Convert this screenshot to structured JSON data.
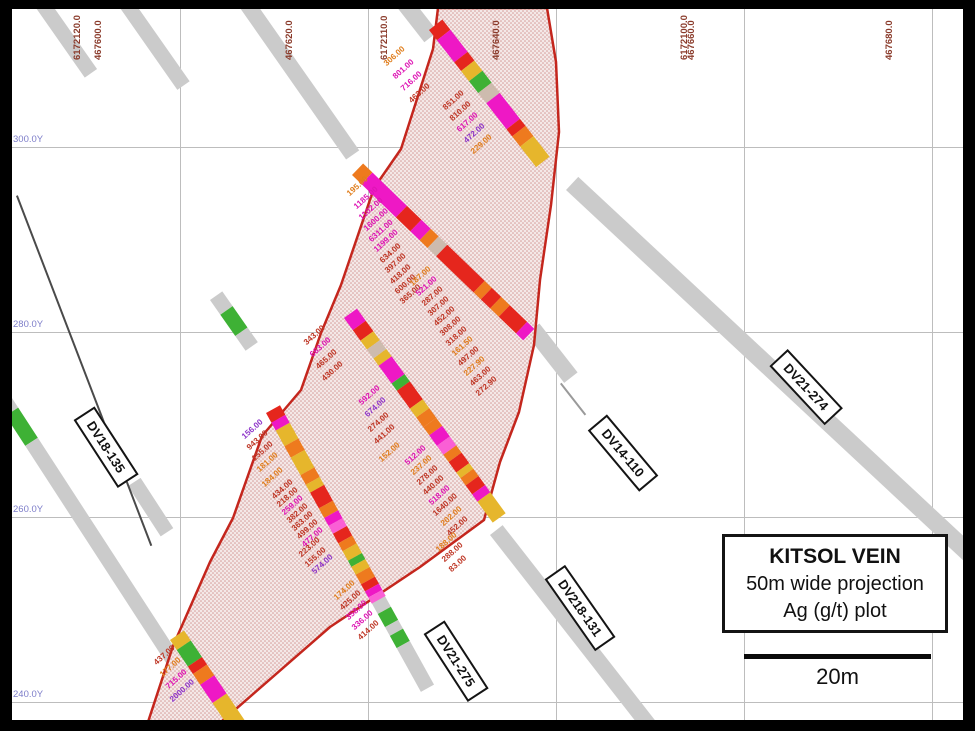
{
  "legend": {
    "title": "KITSOL VEIN",
    "line2": "50m wide projection",
    "line3": "Ag (g/t) plot"
  },
  "scale_bar": {
    "label": "20m"
  },
  "axes": {
    "grid_x": [
      180,
      368,
      556,
      744,
      932
    ],
    "grid_y": [
      147,
      332,
      517,
      702
    ],
    "top_labels": [
      {
        "text": "6172120.0",
        "x": 72
      },
      {
        "text": "467600.0",
        "x": 93
      },
      {
        "text": "467620.0",
        "x": 284
      },
      {
        "text": "6172110.0",
        "x": 379
      },
      {
        "text": "467640.0",
        "x": 491
      },
      {
        "text": "6172100.0",
        "x": 679
      },
      {
        "text": "467660.0",
        "x": 686
      },
      {
        "text": "467680.0",
        "x": 884
      }
    ],
    "left_labels": [
      {
        "text": "300.0Y",
        "y": 147
      },
      {
        "text": "280.0Y",
        "y": 332
      },
      {
        "text": "260.0Y",
        "y": 517
      },
      {
        "text": "240.0Y",
        "y": 702
      }
    ]
  },
  "colors": {
    "gray": "#cbcbcb",
    "linegray": "#9a9a9a",
    "dark": "#4a4a4a",
    "green": "#3eb135",
    "red": "#e5261d",
    "magenta": "#ee18c5",
    "orange": "#ee7a1e",
    "gold": "#e6b62c",
    "tan": "#cdbbae",
    "pink": "#fa5fd5",
    "vo": "#e07e1d",
    "vr": "#bf3726",
    "vm": "#de14b4",
    "vv": "#8e35c9",
    "outline": "#c4261d",
    "grid": "#bdbdbd",
    "coord": "#8a3a2a",
    "ycoord": "#7d7dc9"
  },
  "polygon": {
    "path": "M438,8 L547,8 L556,62 L559,132 L551,205 L540,280 L534,345 L519,412 L500,462 L484,520 L420,567 L330,627 L221,722 L148,722 L173,646 L210,562 L233,518 L262,436 L301,390 L321,333 L341,285 L374,188 L401,149 L433,49 Z"
  },
  "drill_labels": [
    {
      "text": "DV18-135",
      "x": 106,
      "y": 447,
      "rot": 57
    },
    {
      "text": "DV14-110",
      "x": 623,
      "y": 453,
      "rot": 50
    },
    {
      "text": "DV21-274",
      "x": 806,
      "y": 387,
      "rot": 47
    },
    {
      "text": "DV218-131",
      "x": 580,
      "y": 608,
      "rot": 55
    },
    {
      "text": "DV21-275",
      "x": 456,
      "y": 661,
      "rot": 57
    }
  ],
  "gray_traces": [
    {
      "name": "trace-northwest-1",
      "x": 36,
      "y": 8,
      "angle": 55,
      "w": 15,
      "len": 85
    },
    {
      "name": "trace-northwest-2",
      "x": 120,
      "y": 8,
      "angle": 55,
      "w": 15,
      "len": 100
    },
    {
      "name": "trace-northwest-3",
      "x": 240,
      "y": 8,
      "angle": 55,
      "w": 16,
      "len": 185
    },
    {
      "name": "trace-top-lead-in",
      "x": 396,
      "y": 6,
      "angle": 52,
      "w": 17,
      "len": 46
    },
    {
      "name": "trace-dv21-274",
      "x": 566,
      "y": 190,
      "angle": 43,
      "w": 18,
      "len": 560
    },
    {
      "name": "trace-dv14-110-stub",
      "x": 526,
      "y": 334,
      "angle": 52,
      "w": 17,
      "len": 62
    },
    {
      "name": "trace-dv14-110-line",
      "x": 560,
      "y": 384,
      "angle": 52,
      "w": 2,
      "len": 40,
      "c": "linegray"
    },
    {
      "name": "trace-dv218-131",
      "x": 490,
      "y": 535,
      "angle": 52,
      "w": 16,
      "len": 255
    },
    {
      "name": "trace-dv21-275-lower",
      "x": 370,
      "y": 600,
      "angle": 61,
      "w": 15,
      "segments": [
        {
          "c": "gray",
          "l": 16
        },
        {
          "c": "green",
          "l": 15
        },
        {
          "c": "gray",
          "l": 10
        },
        {
          "c": "green",
          "l": 14
        },
        {
          "c": "gray",
          "l": 50
        }
      ]
    },
    {
      "name": "trace-west",
      "x": -2,
      "y": 404,
      "angle": 57,
      "w": 15,
      "segments": [
        {
          "c": "gray",
          "l": 14
        },
        {
          "c": "green",
          "l": 36
        },
        {
          "c": "gray",
          "l": 260
        }
      ]
    },
    {
      "name": "trace-dv18-135-stub",
      "x": 128,
      "y": 486,
      "angle": 57,
      "w": 15,
      "len": 60
    },
    {
      "name": "trace-dv18-135-line",
      "x": 16,
      "y": 196,
      "angle": 69,
      "w": 1.5,
      "len": 375,
      "c": "dark"
    },
    {
      "name": "trace-green-stub",
      "x": 210,
      "y": 300,
      "angle": 55,
      "w": 15,
      "segments": [
        {
          "c": "gray",
          "l": 18
        },
        {
          "c": "green",
          "l": 26
        },
        {
          "c": "gray",
          "l": 18
        }
      ]
    }
  ],
  "bars": [
    {
      "x": 429,
      "y": 30,
      "angle": 52,
      "w": 17,
      "segments": [
        {
          "c": "red",
          "l": 13
        },
        {
          "c": "magenta",
          "l": 28
        },
        {
          "c": "red",
          "l": 11
        },
        {
          "c": "gold",
          "l": 13
        },
        {
          "c": "green",
          "l": 15
        },
        {
          "c": "tan",
          "l": 13
        },
        {
          "c": "magenta",
          "l": 33
        },
        {
          "c": "red",
          "l": 9
        },
        {
          "c": "orange",
          "l": 13
        },
        {
          "c": "gold",
          "l": 26
        }
      ]
    },
    {
      "x": 352,
      "y": 175,
      "angle": 44,
      "w": 16,
      "segments": [
        {
          "c": "orange",
          "l": 13
        },
        {
          "c": "magenta",
          "l": 48
        },
        {
          "c": "red",
          "l": 20
        },
        {
          "c": "magenta",
          "l": 13
        },
        {
          "c": "orange",
          "l": 11
        },
        {
          "c": "tan",
          "l": 12
        },
        {
          "c": "red",
          "l": 52
        },
        {
          "c": "orange",
          "l": 10
        },
        {
          "c": "red",
          "l": 13
        },
        {
          "c": "orange",
          "l": 12
        },
        {
          "c": "red",
          "l": 24
        },
        {
          "c": "magenta",
          "l": 10
        }
      ]
    },
    {
      "x": 344,
      "y": 318,
      "angle": 54,
      "w": 16,
      "segments": [
        {
          "c": "magenta",
          "l": 15
        },
        {
          "c": "red",
          "l": 13
        },
        {
          "c": "gold",
          "l": 11
        },
        {
          "c": "tan",
          "l": 11
        },
        {
          "c": "gold",
          "l": 9
        },
        {
          "c": "magenta",
          "l": 22
        },
        {
          "c": "green",
          "l": 9
        },
        {
          "c": "red",
          "l": 22
        },
        {
          "c": "gold",
          "l": 11
        },
        {
          "c": "orange",
          "l": 12
        },
        {
          "c": "orange",
          "l": 10
        },
        {
          "c": "magenta",
          "l": 13
        },
        {
          "c": "pink",
          "l": 11
        },
        {
          "c": "orange",
          "l": 9
        },
        {
          "c": "red",
          "l": 13
        },
        {
          "c": "gold",
          "l": 7
        },
        {
          "c": "orange",
          "l": 9
        },
        {
          "c": "red",
          "l": 11
        },
        {
          "c": "magenta",
          "l": 9
        },
        {
          "c": "gold",
          "l": 26
        }
      ]
    },
    {
      "x": 266,
      "y": 413,
      "angle": 61,
      "w": 16,
      "segments": [
        {
          "c": "red",
          "l": 11
        },
        {
          "c": "magenta",
          "l": 9
        },
        {
          "c": "gold",
          "l": 18
        },
        {
          "c": "orange",
          "l": 13
        },
        {
          "c": "gold",
          "l": 20
        },
        {
          "c": "orange",
          "l": 11
        },
        {
          "c": "gold",
          "l": 9
        },
        {
          "c": "red",
          "l": 18
        },
        {
          "c": "orange",
          "l": 11
        },
        {
          "c": "magenta",
          "l": 9
        },
        {
          "c": "pink",
          "l": 9
        },
        {
          "c": "red",
          "l": 11
        },
        {
          "c": "orange",
          "l": 9
        },
        {
          "c": "gold",
          "l": 11
        },
        {
          "c": "green",
          "l": 7
        },
        {
          "c": "gold",
          "l": 9
        },
        {
          "c": "orange",
          "l": 11
        },
        {
          "c": "red",
          "l": 8
        },
        {
          "c": "magenta",
          "l": 7
        },
        {
          "c": "pink",
          "l": 7
        }
      ]
    },
    {
      "x": 170,
      "y": 640,
      "angle": 56,
      "w": 17,
      "segments": [
        {
          "c": "gold",
          "l": 12
        },
        {
          "c": "green",
          "l": 20
        },
        {
          "c": "red",
          "l": 9
        },
        {
          "c": "orange",
          "l": 13
        },
        {
          "c": "magenta",
          "l": 22
        },
        {
          "c": "gold",
          "l": 40
        }
      ]
    }
  ],
  "value_labels": [
    {
      "t": "306.00",
      "x": 385,
      "y": 60,
      "c": "vo"
    },
    {
      "t": "801.00",
      "x": 394,
      "y": 73,
      "c": "vm"
    },
    {
      "t": "716.00",
      "x": 402,
      "y": 85,
      "c": "vm"
    },
    {
      "t": "463.00",
      "x": 410,
      "y": 97,
      "c": "vr"
    },
    {
      "t": "851.00",
      "x": 444,
      "y": 104,
      "c": "vr"
    },
    {
      "t": "810.00",
      "x": 451,
      "y": 115,
      "c": "vr"
    },
    {
      "t": "617.00",
      "x": 458,
      "y": 126,
      "c": "vm"
    },
    {
      "t": "472.00",
      "x": 465,
      "y": 137,
      "c": "vv"
    },
    {
      "t": "229.00",
      "x": 472,
      "y": 148,
      "c": "vo"
    },
    {
      "t": "195.00",
      "x": 348,
      "y": 190,
      "c": "vo"
    },
    {
      "t": "1185.00",
      "x": 355,
      "y": 203,
      "c": "vm"
    },
    {
      "t": "1102.00",
      "x": 360,
      "y": 214,
      "c": "vm"
    },
    {
      "t": "1600.00",
      "x": 365,
      "y": 225,
      "c": "vm"
    },
    {
      "t": "6311.00",
      "x": 370,
      "y": 236,
      "c": "vm"
    },
    {
      "t": "1199.00",
      "x": 375,
      "y": 246,
      "c": "vm"
    },
    {
      "t": "634.00",
      "x": 381,
      "y": 257,
      "c": "vr"
    },
    {
      "t": "397.00",
      "x": 386,
      "y": 267,
      "c": "vr"
    },
    {
      "t": "418.00",
      "x": 391,
      "y": 278,
      "c": "vr"
    },
    {
      "t": "600.00",
      "x": 396,
      "y": 288,
      "c": "vr"
    },
    {
      "t": "365.00",
      "x": 401,
      "y": 298,
      "c": "vr"
    },
    {
      "t": "187.00",
      "x": 411,
      "y": 280,
      "c": "vo"
    },
    {
      "t": "521.00",
      "x": 417,
      "y": 290,
      "c": "vm"
    },
    {
      "t": "287.00",
      "x": 423,
      "y": 300,
      "c": "vr"
    },
    {
      "t": "307.00",
      "x": 429,
      "y": 310,
      "c": "vr"
    },
    {
      "t": "452.00",
      "x": 435,
      "y": 320,
      "c": "vr"
    },
    {
      "t": "308.00",
      "x": 441,
      "y": 330,
      "c": "vr"
    },
    {
      "t": "318.00",
      "x": 447,
      "y": 340,
      "c": "vr"
    },
    {
      "t": "161.50",
      "x": 453,
      "y": 350,
      "c": "vo"
    },
    {
      "t": "497.00",
      "x": 459,
      "y": 360,
      "c": "vr"
    },
    {
      "t": "227.90",
      "x": 465,
      "y": 370,
      "c": "vo"
    },
    {
      "t": "463.00",
      "x": 471,
      "y": 380,
      "c": "vr"
    },
    {
      "t": "272.90",
      "x": 477,
      "y": 390,
      "c": "vr"
    },
    {
      "t": "343.00",
      "x": 305,
      "y": 339,
      "c": "vr"
    },
    {
      "t": "663.00",
      "x": 311,
      "y": 351,
      "c": "vm"
    },
    {
      "t": "465.00",
      "x": 317,
      "y": 363,
      "c": "vr"
    },
    {
      "t": "430.00",
      "x": 323,
      "y": 375,
      "c": "vr"
    },
    {
      "t": "592.00",
      "x": 360,
      "y": 399,
      "c": "vm"
    },
    {
      "t": "674.00",
      "x": 366,
      "y": 411,
      "c": "vv"
    },
    {
      "t": "274.00",
      "x": 369,
      "y": 426,
      "c": "vr"
    },
    {
      "t": "441.00",
      "x": 375,
      "y": 438,
      "c": "vr"
    },
    {
      "t": "152.00",
      "x": 380,
      "y": 456,
      "c": "vo"
    },
    {
      "t": "512.00",
      "x": 406,
      "y": 459,
      "c": "vm"
    },
    {
      "t": "237.00",
      "x": 412,
      "y": 469,
      "c": "vo"
    },
    {
      "t": "278.00",
      "x": 418,
      "y": 479,
      "c": "vr"
    },
    {
      "t": "440.00",
      "x": 424,
      "y": 489,
      "c": "vr"
    },
    {
      "t": "518.00",
      "x": 430,
      "y": 499,
      "c": "vm"
    },
    {
      "t": "1640.00",
      "x": 434,
      "y": 510,
      "c": "vr"
    },
    {
      "t": "202.00",
      "x": 442,
      "y": 520,
      "c": "vo"
    },
    {
      "t": "452.00",
      "x": 448,
      "y": 530,
      "c": "vr"
    },
    {
      "t": "188.00",
      "x": 437,
      "y": 546,
      "c": "vo"
    },
    {
      "t": "288.00",
      "x": 443,
      "y": 556,
      "c": "vr"
    },
    {
      "t": "83.00",
      "x": 450,
      "y": 566,
      "c": "vr"
    },
    {
      "t": "156.00",
      "x": 243,
      "y": 433,
      "c": "vv"
    },
    {
      "t": "943.00",
      "x": 248,
      "y": 444,
      "c": "vr"
    },
    {
      "t": "155.00",
      "x": 253,
      "y": 455,
      "c": "vr"
    },
    {
      "t": "181.00",
      "x": 258,
      "y": 466,
      "c": "vo"
    },
    {
      "t": "184.00",
      "x": 263,
      "y": 481,
      "c": "vo"
    },
    {
      "t": "434.00",
      "x": 273,
      "y": 493,
      "c": "vr"
    },
    {
      "t": "218.00",
      "x": 278,
      "y": 501,
      "c": "vr"
    },
    {
      "t": "259.00",
      "x": 283,
      "y": 509,
      "c": "vm"
    },
    {
      "t": "382.00",
      "x": 288,
      "y": 517,
      "c": "vr"
    },
    {
      "t": "363.00",
      "x": 293,
      "y": 525,
      "c": "vr"
    },
    {
      "t": "499.00",
      "x": 298,
      "y": 533,
      "c": "vr"
    },
    {
      "t": "477.00",
      "x": 303,
      "y": 541,
      "c": "vm"
    },
    {
      "t": "223.00",
      "x": 300,
      "y": 551,
      "c": "vr"
    },
    {
      "t": "155.00",
      "x": 306,
      "y": 561,
      "c": "vr"
    },
    {
      "t": "574.00",
      "x": 313,
      "y": 568,
      "c": "vv"
    },
    {
      "t": "174.00",
      "x": 335,
      "y": 594,
      "c": "vo"
    },
    {
      "t": "425.00",
      "x": 341,
      "y": 604,
      "c": "vr"
    },
    {
      "t": "358.00",
      "x": 347,
      "y": 614,
      "c": "vm"
    },
    {
      "t": "336.00",
      "x": 353,
      "y": 624,
      "c": "vm"
    },
    {
      "t": "414.00",
      "x": 359,
      "y": 634,
      "c": "vr"
    },
    {
      "t": "437.00",
      "x": 155,
      "y": 659,
      "c": "vr"
    },
    {
      "t": "177.00",
      "x": 161,
      "y": 671,
      "c": "vo"
    },
    {
      "t": "715.00",
      "x": 167,
      "y": 683,
      "c": "vm"
    },
    {
      "t": "2000.00",
      "x": 171,
      "y": 696,
      "c": "vv"
    }
  ]
}
